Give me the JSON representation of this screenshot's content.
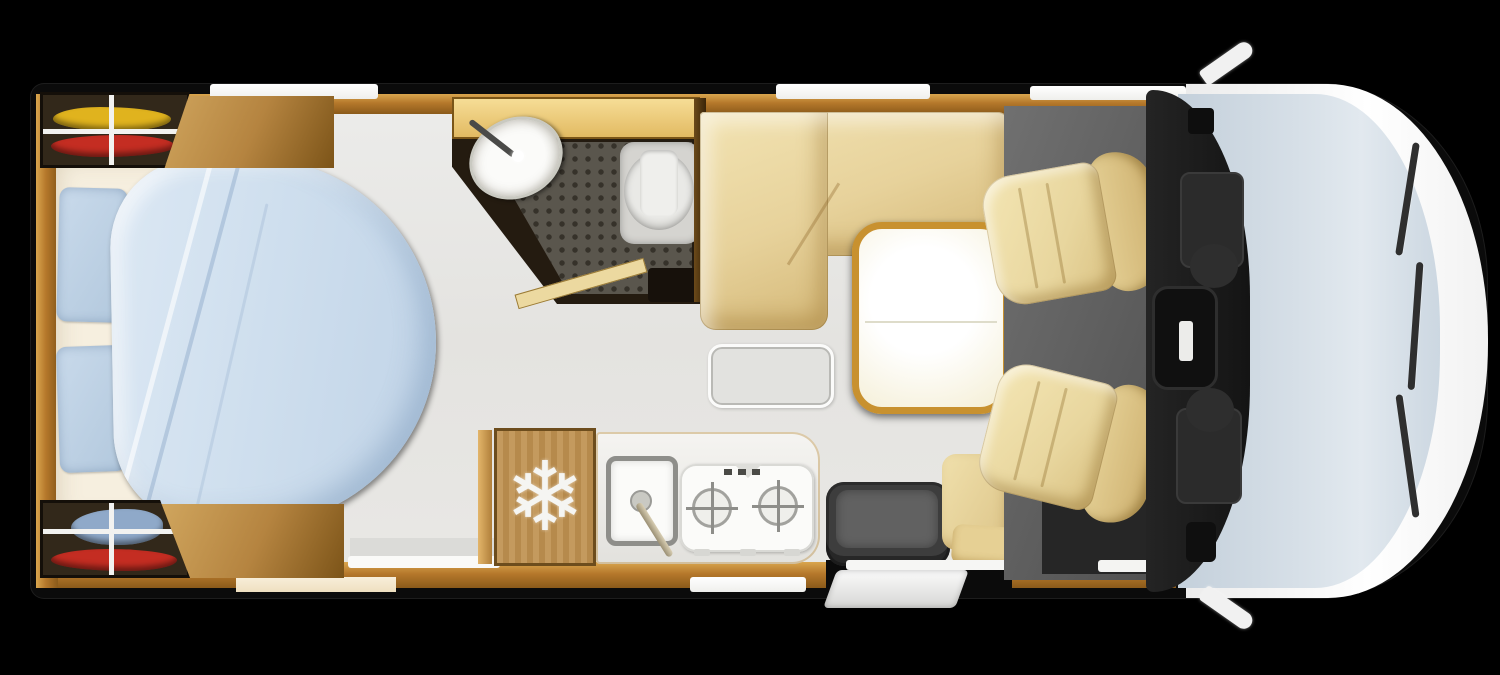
{
  "meta": {
    "title": "Motorhome floor plan — top view",
    "canvas": {
      "width": 1500,
      "height": 675
    },
    "background": "#000000"
  },
  "palette": {
    "wood": "#b5782b",
    "wood_light": "#d9a64e",
    "wood_dark": "#6d4d1d",
    "floor": "#e8e7e4",
    "upholstery_beige": "#e7d29b",
    "bedding_blue": "#cfdfee",
    "pillow_blue": "#b2c8dd",
    "mattress_white": "#f6efdf",
    "bathroom_dark": "#241b10",
    "shower_floor": "#5a564d",
    "fixture_white": "#fbfbf9",
    "table_top": "#fffdf2",
    "table_rim": "#c8912f",
    "cab_floor_grey": "#5e5e5e",
    "dashboard_black": "#1b1b1b",
    "windshield_blue": "#ccd7e1",
    "body_white": "#f5f5f5",
    "gear_yellow": "#e0b31e",
    "gear_red": "#c42d22",
    "gear_blue": "#8fa9c9"
  },
  "areas": {
    "rear_storage": {
      "label": "Rear garage storage with sports gear",
      "top_box_gear": "yellow and red equipment",
      "bottom_box_gear": "blue and red equipment"
    },
    "bedroom": {
      "label": "Rear island bed",
      "fixtures": [
        "mattress",
        "pillow",
        "pillow",
        "rounded duvet",
        "wardrobe panels"
      ]
    },
    "bathroom": {
      "label": "Washroom with shower, basin and toilet",
      "fixtures": [
        "washbasin with faucet",
        "shower grid floor",
        "toilet"
      ]
    },
    "dinette": {
      "label": "L-shaped lounge with pedestal table",
      "fixtures": [
        "L-shaped bench",
        "table with seam",
        "floor hatch"
      ]
    },
    "kitchen": {
      "label": "Kitchenette",
      "fridge_icon": "❄",
      "fixtures": [
        "refrigerator",
        "square sink with faucet",
        "two-burner gas hob"
      ]
    },
    "entrance": {
      "label": "Entrance with step",
      "fixtures": [
        "ottoman",
        "side seat",
        "entry step"
      ]
    },
    "cab": {
      "label": "Driver cab",
      "fixtures": [
        "driver swivel seat",
        "passenger swivel seat",
        "dashboard",
        "steering wheel",
        "windshield",
        "three wipers",
        "two mirrors"
      ]
    }
  }
}
